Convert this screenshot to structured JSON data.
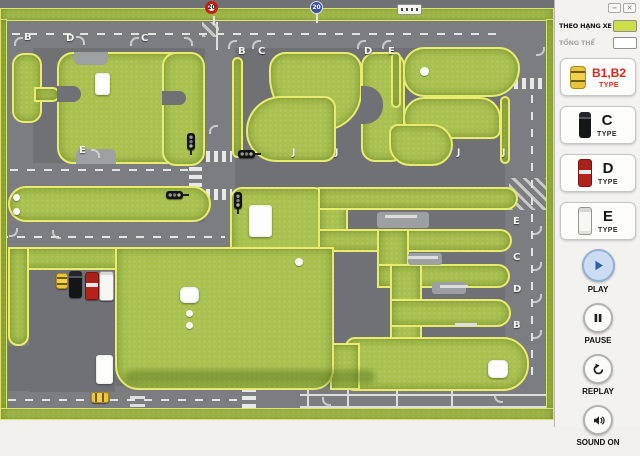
{
  "window": {
    "minimize": "−",
    "close": "✕"
  },
  "sidebar": {
    "legend": [
      {
        "label": "THEO HẠNG XE",
        "active": true
      },
      {
        "label": "TỔNG THỂ",
        "active": false
      }
    ],
    "vehicle_types": [
      {
        "label": "B1,B2",
        "sub": "TYPE"
      },
      {
        "label": "C",
        "sub": "TYPE"
      },
      {
        "label": "D",
        "sub": "TYPE"
      },
      {
        "label": "E",
        "sub": "TYPE"
      }
    ],
    "controls": [
      {
        "label": "PLAY"
      },
      {
        "label": "PAUSE"
      },
      {
        "label": "REPLAY"
      },
      {
        "label": "SOUND ON"
      }
    ]
  },
  "map": {
    "speed_signs": [
      {
        "text": "20",
        "style": "red"
      },
      {
        "text": "20",
        "style": "blue"
      }
    ],
    "labels": [
      {
        "t": "B",
        "x": 24,
        "y": 32
      },
      {
        "t": "D",
        "x": 66,
        "y": 33
      },
      {
        "t": "C",
        "x": 141,
        "y": 33
      },
      {
        "t": "E",
        "x": 79,
        "y": 145
      },
      {
        "t": "B",
        "x": 238,
        "y": 46
      },
      {
        "t": "C",
        "x": 258,
        "y": 46
      },
      {
        "t": "D",
        "x": 364,
        "y": 46
      },
      {
        "t": "E",
        "x": 388,
        "y": 46
      },
      {
        "t": "J",
        "x": 292,
        "y": 148
      },
      {
        "t": "J",
        "x": 335,
        "y": 148
      },
      {
        "t": "J",
        "x": 457,
        "y": 148
      },
      {
        "t": "J",
        "x": 502,
        "y": 148
      },
      {
        "t": "E",
        "x": 513,
        "y": 216
      },
      {
        "t": "C",
        "x": 513,
        "y": 252
      },
      {
        "t": "D",
        "x": 513,
        "y": 284
      },
      {
        "t": "B",
        "x": 513,
        "y": 320
      }
    ],
    "hooks": [
      {
        "x": 14,
        "y": 37,
        "a": 270
      },
      {
        "x": 76,
        "y": 36,
        "a": 0
      },
      {
        "x": 130,
        "y": 37,
        "a": 270
      },
      {
        "x": 184,
        "y": 37,
        "a": 0
      },
      {
        "x": 91,
        "y": 149,
        "a": 0
      },
      {
        "x": 228,
        "y": 40,
        "a": 270
      },
      {
        "x": 252,
        "y": 40,
        "a": 270
      },
      {
        "x": 357,
        "y": 40,
        "a": 270
      },
      {
        "x": 382,
        "y": 40,
        "a": 270
      },
      {
        "x": 536,
        "y": 47,
        "a": 90
      },
      {
        "x": 533,
        "y": 226,
        "a": 90
      },
      {
        "x": 533,
        "y": 262,
        "a": 90
      },
      {
        "x": 533,
        "y": 294,
        "a": 90
      },
      {
        "x": 533,
        "y": 330,
        "a": 90
      },
      {
        "x": 209,
        "y": 125,
        "a": 270
      },
      {
        "x": 494,
        "y": 394,
        "a": 180
      },
      {
        "x": 322,
        "y": 397,
        "a": 180
      },
      {
        "x": 9,
        "y": 228,
        "a": 90
      },
      {
        "x": 52,
        "y": 230,
        "a": 180
      }
    ]
  },
  "colors": {
    "grass": "#a9c14f",
    "grass_border": "#e8eb6e",
    "road": "#6f7174",
    "accent_red": "#d6281e",
    "legend_swatch_active": "#cdde4b",
    "play_button": "#ccdcf3"
  }
}
